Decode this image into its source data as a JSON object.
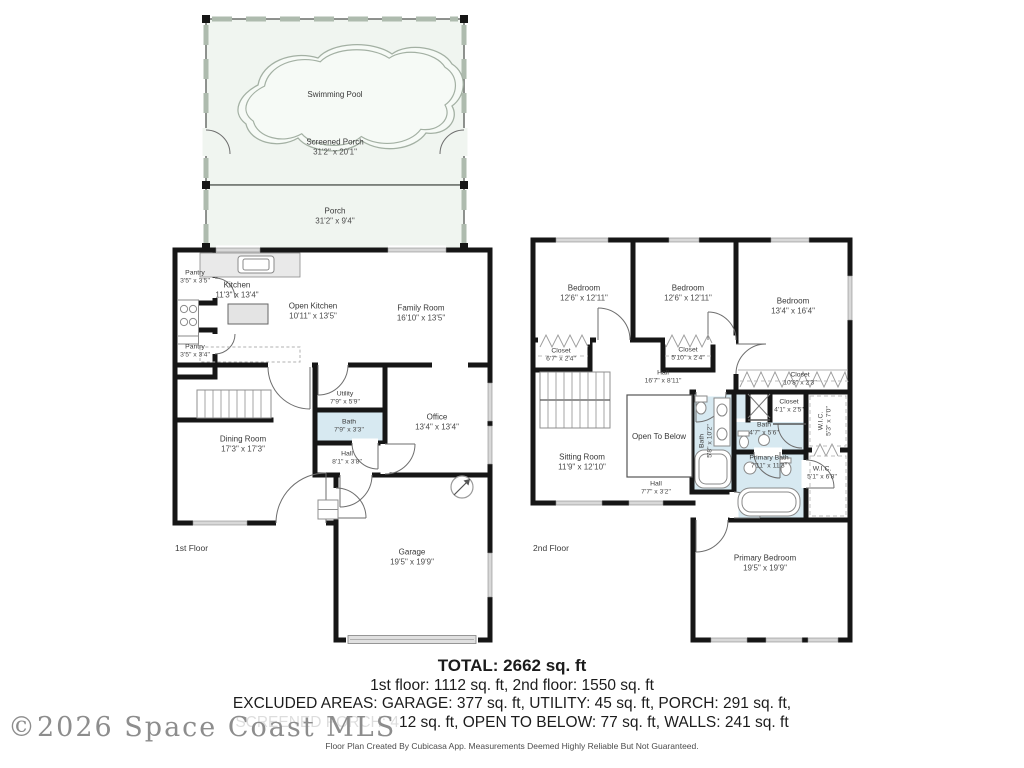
{
  "outdoor": {
    "swimming_pool": "Swimming Pool",
    "screened_porch": {
      "name": "Screened Porch",
      "dims": "31'2\" x 20'1\""
    },
    "porch": {
      "name": "Porch",
      "dims": "31'2\" x 9'4\""
    }
  },
  "floor1": {
    "label": "1st Floor",
    "rooms": {
      "pantry_top": {
        "name": "Pantry",
        "dims": "3'5\" x 3'5\""
      },
      "kitchen": {
        "name": "Kitchen",
        "dims": "11'3\" x 13'4\""
      },
      "open_kitchen": {
        "name": "Open Kitchen",
        "dims": "10'11\" x 13'5\""
      },
      "family_room": {
        "name": "Family Room",
        "dims": "16'10\" x 13'5\""
      },
      "pantry_bottom": {
        "name": "Pantry",
        "dims": "3'5\" x 3'4\""
      },
      "utility": {
        "name": "Utility",
        "dims": "7'9\" x 5'9\""
      },
      "bath": {
        "name": "Bath",
        "dims": "7'9\" x 3'3\""
      },
      "hall": {
        "name": "Hall",
        "dims": "8'1\" x 3'8\""
      },
      "office": {
        "name": "Office",
        "dims": "13'4\" x 13'4\""
      },
      "dining_room": {
        "name": "Dining Room",
        "dims": "17'3\" x 17'3\""
      },
      "garage": {
        "name": "Garage",
        "dims": "19'5\" x 19'9\""
      }
    }
  },
  "floor2": {
    "label": "2nd Floor",
    "rooms": {
      "bedroom_left": {
        "name": "Bedroom",
        "dims": "12'6\" x 12'11\""
      },
      "bedroom_middle": {
        "name": "Bedroom",
        "dims": "12'6\" x 12'11\""
      },
      "bedroom_right": {
        "name": "Bedroom",
        "dims": "13'4\" x 16'4\""
      },
      "closet_left": {
        "name": "Closet",
        "dims": "6'7\" x 2'4\""
      },
      "closet_middle": {
        "name": "Closet",
        "dims": "5'10\" x 2'4\""
      },
      "hall_upper": {
        "name": "Hall",
        "dims": "16'7\" x 8'11\""
      },
      "closet_right": {
        "name": "Closet",
        "dims": "10'8\" x 2'3\""
      },
      "open_to_below": {
        "name": "Open To Below"
      },
      "bath_shared": {
        "name": "Bath",
        "dims": "5'8\" x 10'2\""
      },
      "closet_small": {
        "name": "Closet",
        "dims": "4'1\" x 2'5\""
      },
      "bath_small": {
        "name": "Bath",
        "dims": "4'7\" x 5'6\""
      },
      "wic_upper": {
        "name": "W.I.C.",
        "dims": "5'3\" x 7'0\""
      },
      "primary_bath": {
        "name": "Primary Bath",
        "dims": "7'11\" x 11'3\""
      },
      "wic_lower": {
        "name": "W.I.C.",
        "dims": "5'1\" x 6'8\""
      },
      "sitting_room": {
        "name": "Sitting Room",
        "dims": "11'9\" x 12'10\""
      },
      "hall_lower": {
        "name": "Hall",
        "dims": "7'7\" x 3'2\""
      },
      "primary_bedroom": {
        "name": "Primary Bedroom",
        "dims": "19'5\" x 19'9\""
      }
    }
  },
  "summary": {
    "total": "TOTAL: 2662 sq. ft",
    "floors": "1st floor: 1112 sq. ft, 2nd floor: 1550 sq. ft",
    "excluded1": "EXCLUDED AREAS: GARAGE: 377 sq. ft, UTILITY: 45 sq. ft, PORCH: 291 sq. ft,",
    "excluded2": "SCREENED PORCH: 412 sq. ft, OPEN TO BELOW: 77 sq. ft, WALLS: 241 sq. ft",
    "disclaimer": "Floor Plan Created By Cubicasa App. Measurements Deemed Highly Reliable But Not Guaranteed."
  },
  "watermark": "©2026 Space Coast MLS",
  "colors": {
    "wall": "#161616",
    "bath_fill": "#d7e9f1",
    "porch_fill": "#f0f5f0",
    "window_gray": "#d8d8d8"
  }
}
